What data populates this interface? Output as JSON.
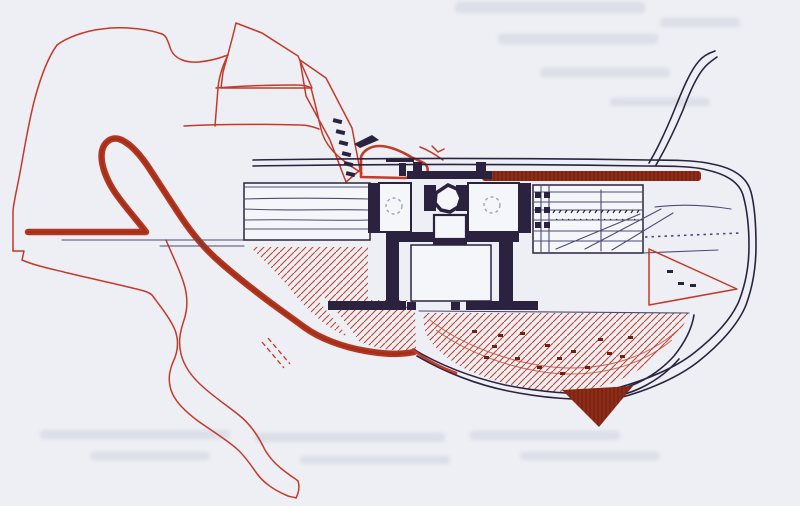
{
  "canvas": {
    "viewBox": "0 0 800 506"
  },
  "colors": {
    "paper": "#edeff4",
    "paper_bright": "#f5f6f9",
    "ink": "#2b2240",
    "ink_soft": "#4d4a78",
    "sketch_red": "#c5392a",
    "hatch_red": "#c4452f",
    "road_red": "#b5371f",
    "road_red_dark": "#932916",
    "brick": "#8e2c17",
    "brick_dark": "#6f2010",
    "ghost": "#c3c8d6",
    "dash_gray": "#9aa3c4"
  },
  "figure": {
    "kind": "hand-drawn architectural site plan sketch, red and dark ink on paper",
    "elements": [
      {
        "name": "bleed-through-ghosts",
        "description": "faint gray smudges of text showing through the scanned page"
      },
      {
        "name": "site-boundary-outline",
        "description": "thin red irregular site boundary looping down to a winding tail at bottom center"
      },
      {
        "name": "contour-lines",
        "description": "two thin red contour lines across the white knoll"
      },
      {
        "name": "upper-hatched-wedge",
        "description": "red diagonal-hatched wedge at top center"
      },
      {
        "name": "hatched-slope-band",
        "description": "red hatched slope band with dark stair marks descending to the building"
      },
      {
        "name": "stair-marks",
        "description": "column of small dark steps"
      },
      {
        "name": "pavilion-sketch",
        "description": "small thick-red outlined pavilion with dark table mark"
      },
      {
        "name": "thick-access-road",
        "description": "bold dark-red road with hairpin loop sweeping to the lower terrace"
      },
      {
        "name": "left-terrace-hatch",
        "description": "red hatched terrace below the left wing"
      },
      {
        "name": "left-wing",
        "description": "long rectangular wing with parallel floor lines"
      },
      {
        "name": "colonnade-roof-bar",
        "description": "solid dark-red roof bar over the colonnade"
      },
      {
        "name": "central-building",
        "description": "thick-walled core with octagonal fountain, twin rooms and U-shaped courtyard"
      },
      {
        "name": "right-wing",
        "description": "gridded hall with tick-hatched gallery and braced bays"
      },
      {
        "name": "right-hatch-triangle",
        "description": "red hatched triangle below the right wing"
      },
      {
        "name": "garden-fan",
        "description": "fan-shaped hatched garden with scattered plant dashes"
      },
      {
        "name": "dark-red-triangle",
        "description": "solid dark-red triangular point at the bottom of the fan"
      },
      {
        "name": "perimeter-road",
        "description": "double-line road along the top curving around the right side"
      },
      {
        "name": "branch-road",
        "description": "double-line road branching up to the top right"
      }
    ]
  }
}
